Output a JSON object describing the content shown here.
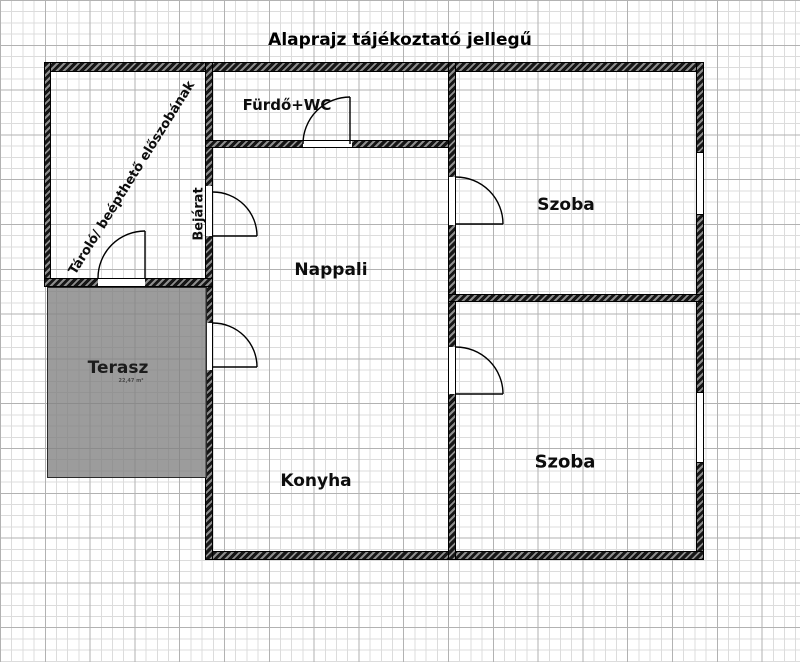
{
  "title": "Alaprajz tájékoztató jellegű",
  "labels": {
    "storage_note": "Tároló/ beépthető előszobának",
    "entrance": "Bejárat",
    "bathroom": "Fürdő+WC",
    "room_top": "Szoba",
    "living_room": "Nappali",
    "kitchen": "Konyha",
    "room_bottom": "Szoba",
    "terrace": "Terasz",
    "terrace_area": "22,47 m²"
  },
  "colors": {
    "wall": "#161616",
    "wall_hatch_light": "#8d8d8d",
    "terrace_fill": "#9f9f9f",
    "grid_minor": "#dcdcdc",
    "grid_major": "#b2b2b2",
    "text": "#0d0d0d"
  }
}
